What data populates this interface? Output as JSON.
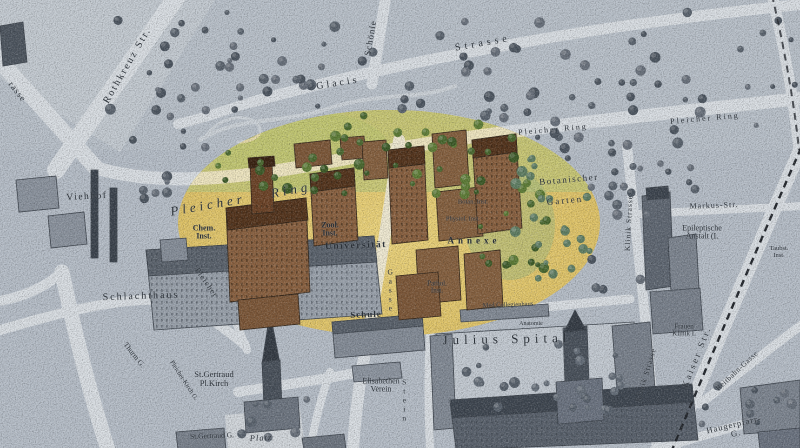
{
  "map": {
    "title": "Historical city map with highlighted university quarter",
    "colors": {
      "paper_gray": "#b6bec8",
      "street": "#dadfe4",
      "highlight_yellow": "#e0c468",
      "highlight_park_green": "#c4c878",
      "tree_green": "#4e6f33",
      "building_brown": "#8a6140",
      "building_gray": "#8b939e",
      "ink": "#2b3138",
      "railway": "#23272d"
    },
    "labels": [
      {
        "id": "rothkreuz-strasse",
        "text": "Rothkreuz Str.",
        "x": 128,
        "y": 66,
        "rot": -60,
        "size": 10,
        "ls": 2
      },
      {
        "id": "strasse-partial",
        "text": "rasse",
        "x": 17,
        "y": 92,
        "rot": 52,
        "size": 9,
        "ls": 1
      },
      {
        "id": "glacis",
        "text": "Glacis",
        "x": 338,
        "y": 84,
        "rot": -9,
        "size": 10,
        "ls": 3
      },
      {
        "id": "glacis-strasse",
        "text": "Strasse",
        "x": 483,
        "y": 44,
        "rot": -10,
        "size": 10,
        "ls": 4
      },
      {
        "id": "schoenle-strasse",
        "text": "Schönle",
        "x": 371,
        "y": 38,
        "rot": -80,
        "size": 9,
        "ls": 1
      },
      {
        "id": "pleicher-ring-ne-1",
        "text": "Pleicher Ring",
        "x": 553,
        "y": 130,
        "rot": -5,
        "size": 8,
        "ls": 2
      },
      {
        "id": "pleicher-ring-ne-2",
        "text": "Pleicher Ring",
        "x": 705,
        "y": 119,
        "rot": -5,
        "size": 8,
        "ls": 2
      },
      {
        "id": "pleicher-ring-big-1",
        "text": "Pleicher",
        "x": 208,
        "y": 205,
        "rot": -10,
        "size": 13,
        "ls": 4,
        "italic": true
      },
      {
        "id": "pleicher-ring-big-2",
        "text": "Ring",
        "x": 291,
        "y": 190,
        "rot": -10,
        "size": 13,
        "ls": 4,
        "italic": true
      },
      {
        "id": "pleicher-sw",
        "text": "Pleicher",
        "x": 206,
        "y": 283,
        "rot": 55,
        "size": 8,
        "ls": 1
      },
      {
        "id": "viehhof",
        "text": "Viehhof",
        "x": 87,
        "y": 198,
        "rot": -3,
        "size": 9.5,
        "ls": 1.5
      },
      {
        "id": "schlachthaus",
        "text": "Schlachthaus",
        "x": 141,
        "y": 297,
        "rot": -2,
        "size": 10,
        "ls": 2
      },
      {
        "id": "chem-inst",
        "text": "Chem.\nInst.",
        "x": 204,
        "y": 233,
        "rot": 0,
        "size": 8,
        "bold": true
      },
      {
        "id": "chem-inst-cross",
        "text": "+",
        "x": 204,
        "y": 249,
        "rot": 0,
        "size": 9
      },
      {
        "id": "zool-inst",
        "text": "Zool.\nInst.",
        "x": 330,
        "y": 230,
        "rot": 0,
        "size": 8,
        "bold": true
      },
      {
        "id": "universitaet",
        "text": "Universität",
        "x": 356,
        "y": 247,
        "rot": -2,
        "size": 9.5,
        "ls": 1.5,
        "bold": true
      },
      {
        "id": "botan-inst",
        "text": "Botan. Inst.",
        "x": 473,
        "y": 203,
        "rot": 0,
        "size": 6.5
      },
      {
        "id": "physiol-inst",
        "text": "Physiol. Inst.",
        "x": 463,
        "y": 220,
        "rot": 0,
        "size": 6.5
      },
      {
        "id": "annexe",
        "text": "Annexe",
        "x": 474,
        "y": 241,
        "rot": 0,
        "size": 9,
        "ls": 4,
        "bold": true
      },
      {
        "id": "pathol-inst",
        "text": "Pathol.\nInst.",
        "x": 437,
        "y": 288,
        "rot": 0,
        "size": 7
      },
      {
        "id": "botanischer-garten-1",
        "text": "Botanischer",
        "x": 569,
        "y": 180,
        "rot": -5,
        "size": 9,
        "ls": 1.5
      },
      {
        "id": "botanischer-garten-2",
        "text": "Garten",
        "x": 565,
        "y": 201,
        "rot": -5,
        "size": 9,
        "ls": 2
      },
      {
        "id": "schule",
        "text": "Schule",
        "x": 366,
        "y": 315,
        "rot": -2,
        "size": 9,
        "ls": 1,
        "bold": true
      },
      {
        "id": "med-collegienhaus",
        "text": "Med Collegienhaus",
        "x": 508,
        "y": 306,
        "rot": -2,
        "size": 6.5
      },
      {
        "id": "anatomie",
        "text": "Anatomie",
        "x": 531,
        "y": 324,
        "rot": 0,
        "size": 6
      },
      {
        "id": "julius-spital",
        "text": "Julius Spital",
        "x": 507,
        "y": 339,
        "rot": -1,
        "size": 13,
        "ls": 5
      },
      {
        "id": "st-gertraud-kirche",
        "text": "St.Gertraud\nPl.Kirch",
        "x": 214,
        "y": 379,
        "rot": 0,
        "size": 8.5
      },
      {
        "id": "elisabethen-verein",
        "text": "Elisabethen\nVerein",
        "x": 381,
        "y": 386,
        "rot": 0,
        "size": 8
      },
      {
        "id": "markus-str",
        "text": "Markus-Str.",
        "x": 714,
        "y": 206,
        "rot": -2,
        "size": 8,
        "ls": 1
      },
      {
        "id": "epileptische-anstalt",
        "text": "Epileptische\nAnstalt (I.",
        "x": 702,
        "y": 233,
        "rot": 0,
        "size": 8
      },
      {
        "id": "klinik-strasse-n",
        "text": "Klinik Strasse",
        "x": 629,
        "y": 223,
        "rot": -87,
        "size": 7.5,
        "ls": 1
      },
      {
        "id": "klinik-strasse-s",
        "text": "Klinik Strasse",
        "x": 646,
        "y": 375,
        "rot": -73,
        "size": 7.5,
        "ls": 1
      },
      {
        "id": "frauen-klinik",
        "text": "Frauen\nKlinik I.",
        "x": 684,
        "y": 331,
        "rot": 0,
        "size": 7
      },
      {
        "id": "kaiser-str",
        "text": "Kaiser Str.",
        "x": 697,
        "y": 357,
        "rot": -68,
        "size": 9,
        "ls": 2.5
      },
      {
        "id": "reitbahn-gasse",
        "text": "Reitbahn-Gasse",
        "x": 737,
        "y": 371,
        "rot": -43,
        "size": 7.5,
        "ls": 0.5
      },
      {
        "id": "haugerpfarr-g",
        "text": "Haugerpfarr-G.",
        "x": 735,
        "y": 429,
        "rot": -13,
        "size": 8.5,
        "ls": 1
      },
      {
        "id": "taubstummen-inst",
        "text": "Taubst.\nInst.",
        "x": 779,
        "y": 253,
        "rot": 0,
        "size": 6.5
      },
      {
        "id": "steingasse-gasse",
        "text": "Gasse",
        "x": 390,
        "y": 290,
        "rot": 0,
        "size": 7.5,
        "stacked": true
      },
      {
        "id": "steingasse-stein",
        "text": "Stein",
        "x": 404,
        "y": 400,
        "rot": 0,
        "size": 7.5,
        "stacked": true
      },
      {
        "id": "thurm-g",
        "text": "Thurm G.",
        "x": 134,
        "y": 355,
        "rot": 52,
        "size": 7.5
      },
      {
        "id": "pleicher-kirch-g",
        "text": "Pleicher-Kirch G.",
        "x": 183,
        "y": 381,
        "rot": 57,
        "size": 6.5
      },
      {
        "id": "gertraud-g",
        "text": "St.Gertraud G.",
        "x": 212,
        "y": 436,
        "rot": -2,
        "size": 7.5
      },
      {
        "id": "platz",
        "text": "Platz",
        "x": 261,
        "y": 438,
        "rot": -3,
        "size": 8.5,
        "ls": 1,
        "italic": true
      }
    ]
  }
}
